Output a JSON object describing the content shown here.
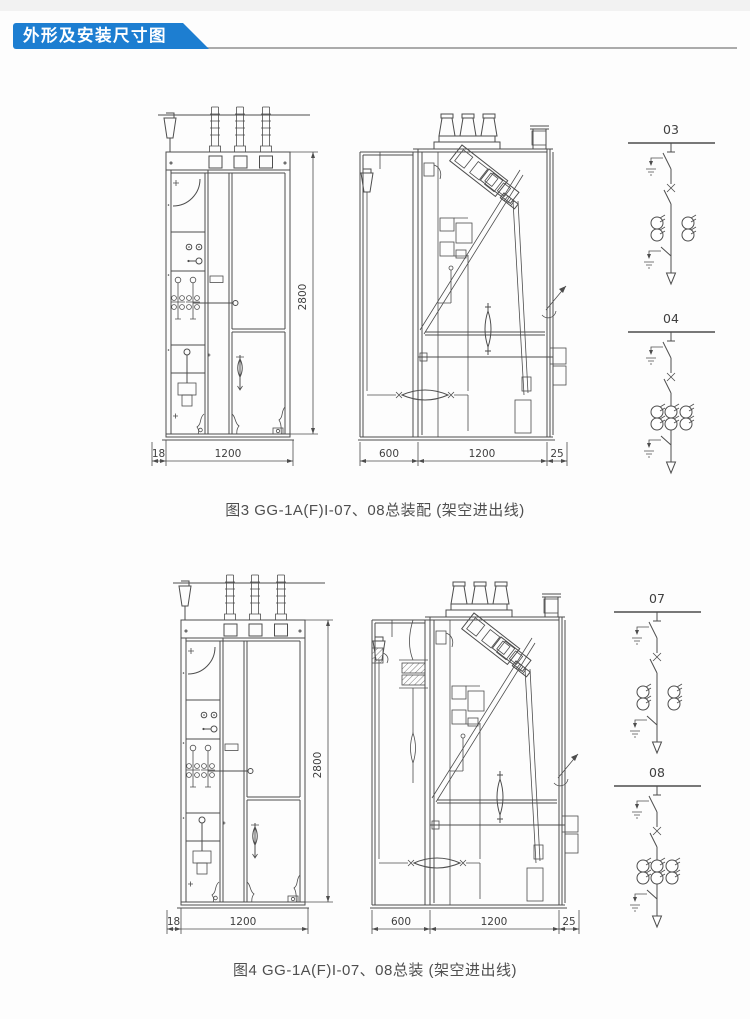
{
  "header": {
    "title": "外形及安装尺寸图",
    "banner_color": "#1d7ed1",
    "divider_color": "#ababab"
  },
  "colors": {
    "drawing_line": "#4d4d4d",
    "dimension_text": "#3f3f3f",
    "page_background": "#fdfdfd"
  },
  "figures": [
    {
      "caption": "图3 GG-1A(F)I-07、08总装配 (架空进出线)",
      "front_view": {
        "dims": {
          "offset": "18",
          "width": "1200",
          "height": "2800"
        }
      },
      "side_view": {
        "dims": {
          "front": "600",
          "depth": "1200",
          "rear": "25"
        }
      },
      "schematics": [
        {
          "label": "03"
        },
        {
          "label": "04"
        }
      ]
    },
    {
      "caption": "图4 GG-1A(F)I-07、08总装 (架空进出线)",
      "front_view": {
        "dims": {
          "offset": "18",
          "width": "1200",
          "height": "2800"
        }
      },
      "side_view": {
        "dims": {
          "front": "600",
          "depth": "1200",
          "rear": "25"
        }
      },
      "schematics": [
        {
          "label": "07"
        },
        {
          "label": "08"
        }
      ]
    }
  ]
}
